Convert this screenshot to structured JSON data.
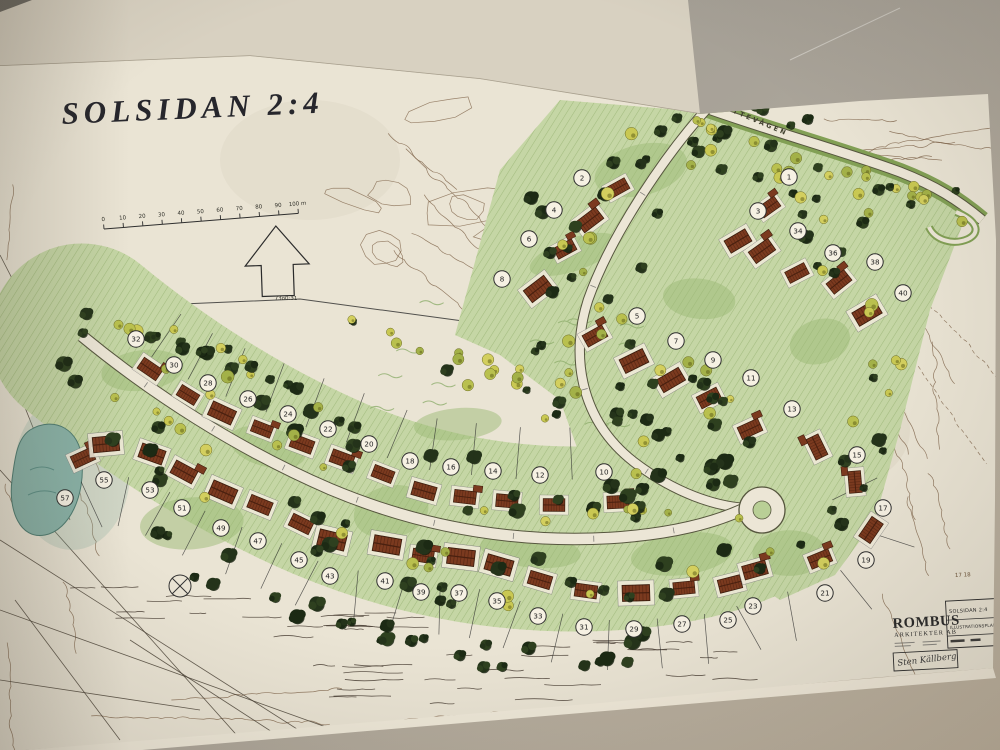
{
  "title": "SOLSIDAN 2:4",
  "scale_bar": {
    "tick_labels": [
      "0",
      "10",
      "20",
      "30",
      "40",
      "50",
      "60",
      "70",
      "80",
      "90"
    ],
    "end_label": "100 m"
  },
  "north_arrow": {
    "caption": "73o0:31"
  },
  "street": {
    "name": "SKYTTEVÄGEN"
  },
  "margin_note": "17 18",
  "title_block": {
    "firm_line1": "ROMBUS",
    "firm_line2": "ARKITEKTER AB",
    "project": "SOLSIDAN 2:4",
    "drawing_type": "ILLUSTRATIONSPLAN",
    "signature": "Sten Källberg"
  },
  "lots": {
    "upper_band": [
      {
        "n": "32",
        "x": 136,
        "y": 339
      },
      {
        "n": "30",
        "x": 174,
        "y": 365
      },
      {
        "n": "28",
        "x": 208,
        "y": 383
      },
      {
        "n": "26",
        "x": 248,
        "y": 399
      },
      {
        "n": "24",
        "x": 288,
        "y": 414
      },
      {
        "n": "22",
        "x": 328,
        "y": 429
      },
      {
        "n": "20",
        "x": 369,
        "y": 444
      },
      {
        "n": "18",
        "x": 410,
        "y": 461
      },
      {
        "n": "16",
        "x": 451,
        "y": 467
      },
      {
        "n": "14",
        "x": 493,
        "y": 471
      },
      {
        "n": "12",
        "x": 540,
        "y": 475
      },
      {
        "n": "10",
        "x": 604,
        "y": 472
      }
    ],
    "lower_band": [
      {
        "n": "57",
        "x": 65,
        "y": 498
      },
      {
        "n": "55",
        "x": 104,
        "y": 480
      },
      {
        "n": "53",
        "x": 150,
        "y": 490
      },
      {
        "n": "51",
        "x": 182,
        "y": 508
      },
      {
        "n": "49",
        "x": 221,
        "y": 528
      },
      {
        "n": "47",
        "x": 258,
        "y": 541
      },
      {
        "n": "45",
        "x": 299,
        "y": 560
      },
      {
        "n": "43",
        "x": 330,
        "y": 576
      },
      {
        "n": "41",
        "x": 385,
        "y": 581
      },
      {
        "n": "39",
        "x": 421,
        "y": 592
      },
      {
        "n": "37",
        "x": 459,
        "y": 593
      },
      {
        "n": "35",
        "x": 497,
        "y": 601
      },
      {
        "n": "33",
        "x": 538,
        "y": 616
      },
      {
        "n": "31",
        "x": 584,
        "y": 627
      },
      {
        "n": "29",
        "x": 634,
        "y": 629
      },
      {
        "n": "27",
        "x": 682,
        "y": 624
      },
      {
        "n": "25",
        "x": 728,
        "y": 620
      },
      {
        "n": "23",
        "x": 753,
        "y": 606
      },
      {
        "n": "21",
        "x": 825,
        "y": 593
      },
      {
        "n": "19",
        "x": 866,
        "y": 560
      },
      {
        "n": "17",
        "x": 883,
        "y": 508
      },
      {
        "n": "15",
        "x": 857,
        "y": 455
      }
    ],
    "east_block": [
      {
        "n": "2",
        "x": 582,
        "y": 178,
        "g": "w"
      },
      {
        "n": "4",
        "x": 554,
        "y": 210,
        "g": "w"
      },
      {
        "n": "6",
        "x": 529,
        "y": 239,
        "g": "w"
      },
      {
        "n": "8",
        "x": 502,
        "y": 279,
        "g": "w"
      },
      {
        "n": "1",
        "x": 789,
        "y": 177,
        "g": "n"
      },
      {
        "n": "3",
        "x": 758,
        "y": 211,
        "g": "n"
      },
      {
        "n": "34",
        "x": 798,
        "y": 231,
        "g": "e"
      },
      {
        "n": "36",
        "x": 833,
        "y": 253,
        "g": "e"
      },
      {
        "n": "38",
        "x": 875,
        "y": 262,
        "g": "e"
      },
      {
        "n": "40",
        "x": 903,
        "y": 293,
        "g": "e"
      },
      {
        "n": "5",
        "x": 637,
        "y": 316,
        "g": "i"
      },
      {
        "n": "7",
        "x": 676,
        "y": 341,
        "g": "i"
      },
      {
        "n": "9",
        "x": 713,
        "y": 360,
        "g": "i"
      },
      {
        "n": "11",
        "x": 751,
        "y": 378,
        "g": "i"
      },
      {
        "n": "13",
        "x": 792,
        "y": 409,
        "g": "i"
      }
    ]
  },
  "colors": {
    "paper": "#eae4d4",
    "upper_sheet": "#d8d1c1",
    "table": "#a39e96",
    "vegetation": "#c5d6a5",
    "veg_hatch": "#7fa258",
    "veg_dark": "#9cba76",
    "conifer": "#242f17",
    "deciduous": "#c6c554",
    "roof": "#7b3a1f",
    "road": "#ece6d6",
    "road_edge": "#56563e",
    "contour": "#7d6147",
    "pond": "#8ab3a8"
  }
}
